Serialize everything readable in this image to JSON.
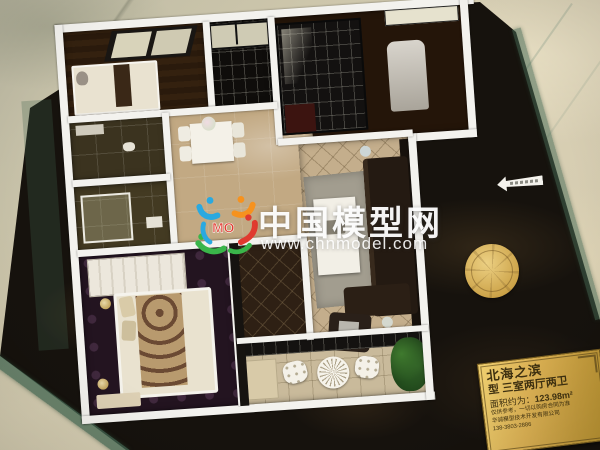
{
  "scene": {
    "type": "photograph",
    "subject": "Architectural scale model of a three-bedroom apartment floor plan displayed on a dark glass-edged base over a marble floor"
  },
  "watermark": {
    "site_name": "中国模型网",
    "site_url": "www.chnmodel.com",
    "logo_monogram": "MO",
    "text_color": "#ffffff",
    "logo_colors": {
      "blue": "#2aa9e0",
      "orange": "#f6921e",
      "green": "#3ab54a",
      "red": "#e03a2f"
    }
  },
  "plaque": {
    "project_name": "北海之滨",
    "unit_type": "型 三室两厅两卫",
    "area_label": "面积约为：",
    "area_value": "123.98m²",
    "disclaimer": "仅供参考，一切以购房合同为准",
    "company": "华诚模型技术开发有限公司",
    "phone": "138-3803-2886",
    "bg_color": "#d4a94a",
    "text_color": "#3f3110"
  },
  "colors": {
    "marble_floor": "#cfc8b0",
    "display_base": "#16120d",
    "base_glass_edge": "#466954",
    "model_walls": "#f3f2ee",
    "medallion_gold": "#cda44a",
    "arrow_sticker": "#f4f2ec"
  }
}
